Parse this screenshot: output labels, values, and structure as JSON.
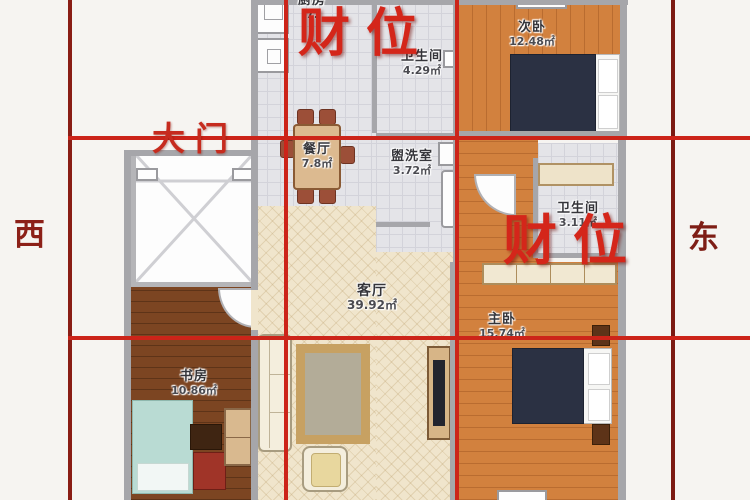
{
  "compass": {
    "west": "西",
    "east": "东"
  },
  "annotations": {
    "main_door": "大门",
    "wealth_top": "财位",
    "wealth_right": "财位"
  },
  "rooms": [
    {
      "id": "kitchen",
      "name": "厨房",
      "area": "7."
    },
    {
      "id": "bath-top",
      "name": "卫生间",
      "area": "4.29㎡"
    },
    {
      "id": "second-bedroom",
      "name": "次卧",
      "area": "12.48㎡"
    },
    {
      "id": "dining",
      "name": "餐厅",
      "area": "7.8㎡"
    },
    {
      "id": "laundry",
      "name": "盥洗室",
      "area": "3.72㎡"
    },
    {
      "id": "bath-master",
      "name": "卫生间",
      "area": "3.11㎡"
    },
    {
      "id": "living",
      "name": "客厅",
      "area": "39.92㎡"
    },
    {
      "id": "master-bedroom",
      "name": "主卧",
      "area": "15.74㎡"
    },
    {
      "id": "study",
      "name": "书房",
      "area": "10.86㎡"
    }
  ],
  "colors": {
    "grid_red": "#cc2419",
    "grid_dark_red": "#8a1d15",
    "wealth_red": "#d4261a",
    "wood_orange": "#d2813e",
    "wood_dark": "#7c4522",
    "living_beige": "#f0e5cc",
    "tile_gray": "#e4e4e8",
    "wall_gray": "#a6a6aa",
    "bed_navy": "#2b3143"
  }
}
